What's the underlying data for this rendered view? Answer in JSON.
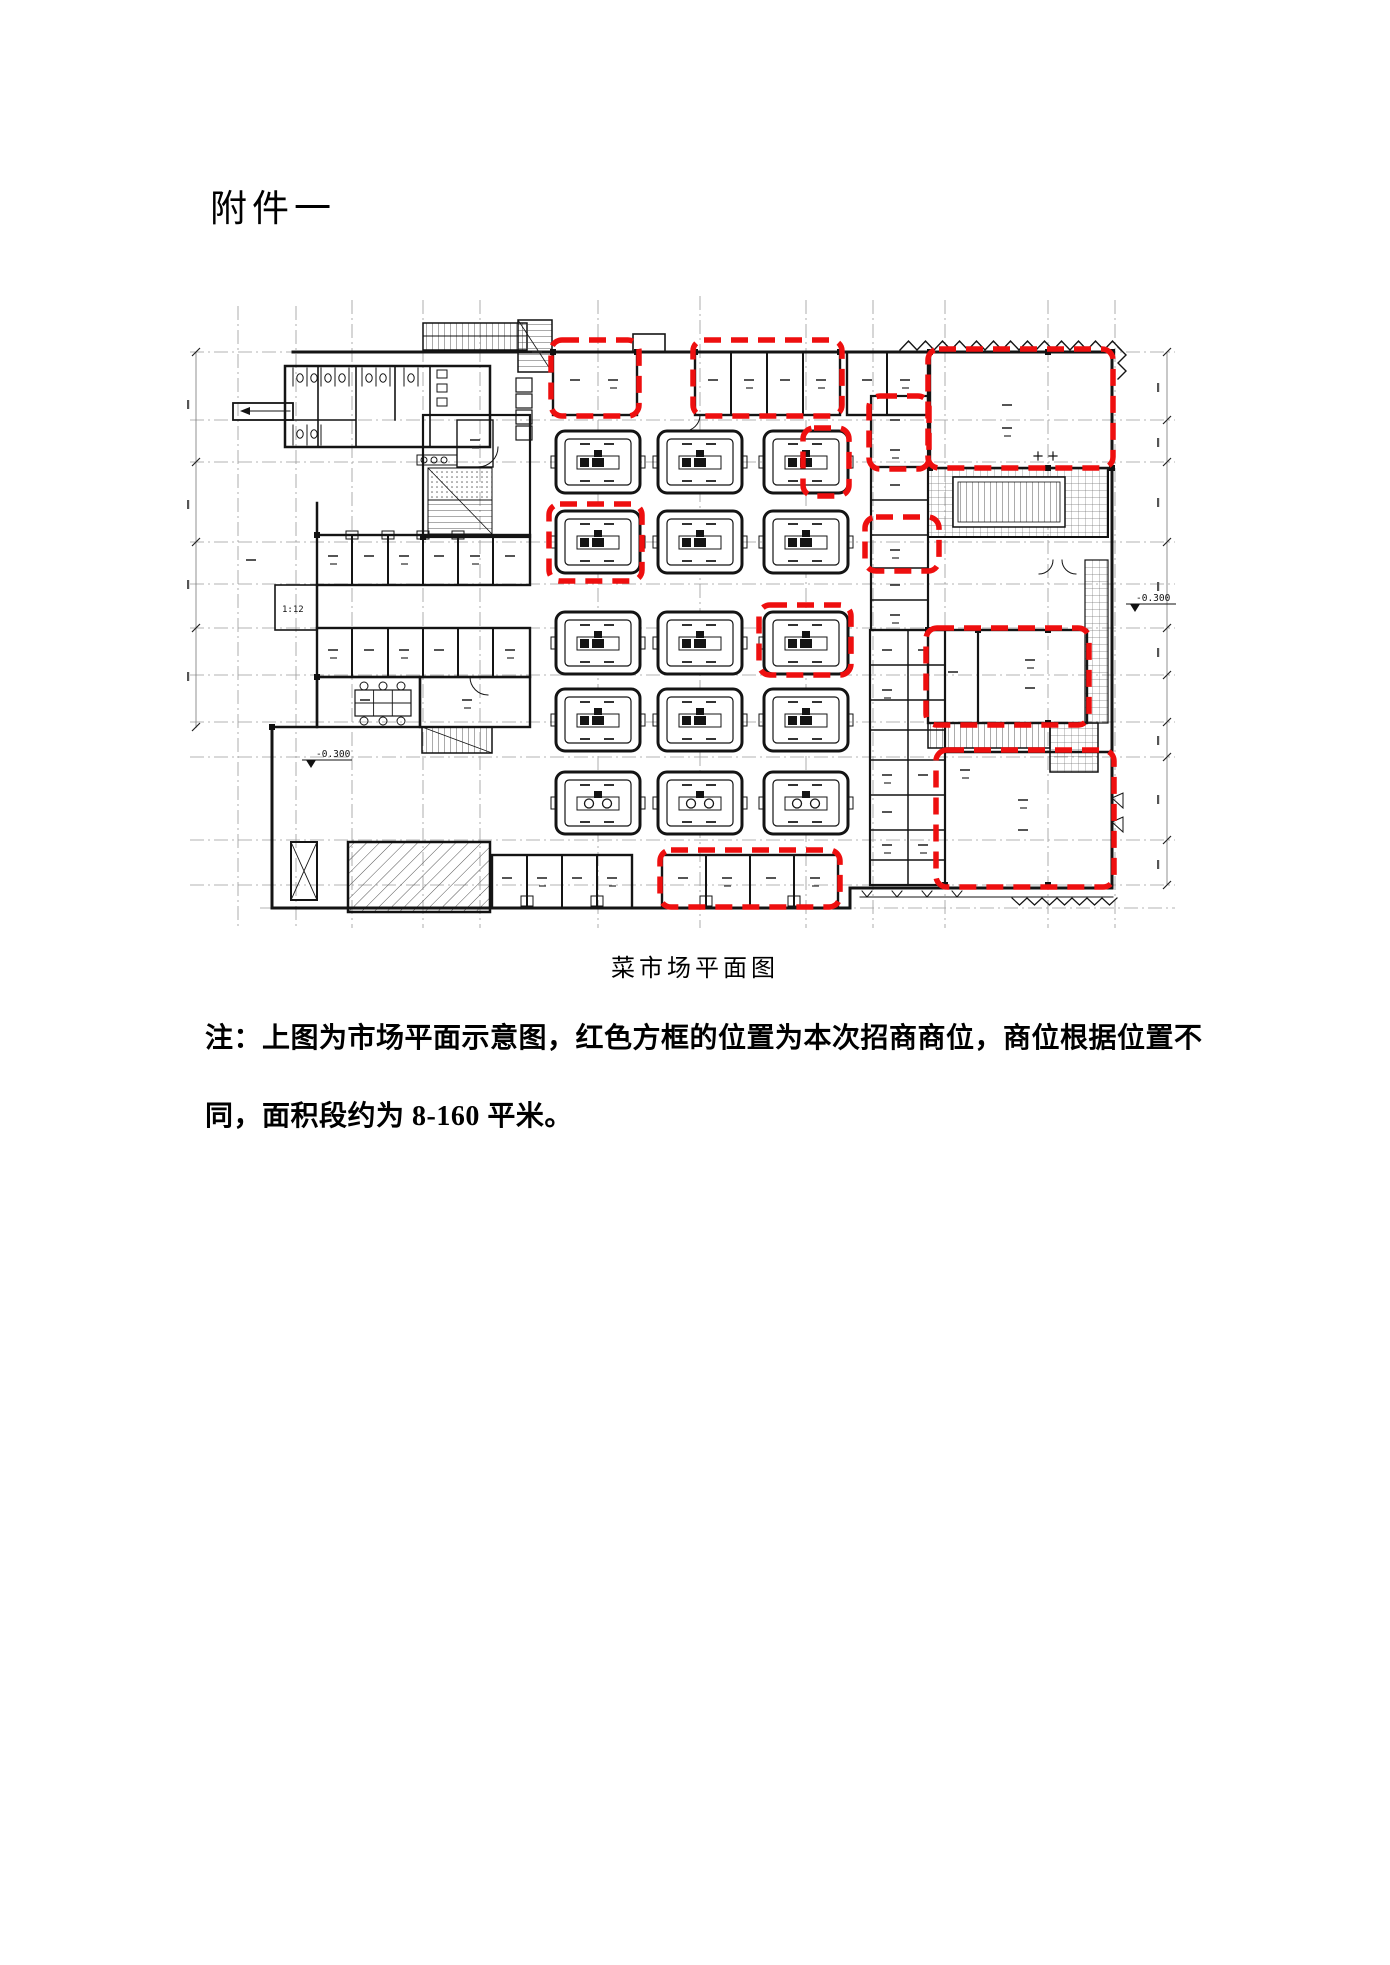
{
  "page": {
    "background": "#ffffff",
    "title": "附件一",
    "caption": "菜市场平面图",
    "note": {
      "line1": "注：上图为市场平面示意图，红色方框的位置为本次招商商位，商位根据位置不",
      "line2": "同，面积段约为 8-160 平米。"
    }
  },
  "floor_plan": {
    "type": "cad-floor-plan",
    "subject": "菜市场平面图（市场平面示意图）",
    "highlight_meaning": "红色方框为本次招商商位，面积段约 8-160 平米",
    "colors": {
      "walls": "#141414",
      "grid": "#9a9a9a",
      "highlight_red": "#ee0f0f",
      "hatch": "#666666"
    },
    "labels": {
      "ramp": "1:12",
      "elevation_left": "-0.300",
      "elevation_right": "-0.300"
    },
    "stall_islands": {
      "col_centers_x": [
        598,
        700,
        806
      ],
      "row_centers_y": [
        462,
        542,
        643,
        720,
        803
      ],
      "width": 84,
      "height": 62,
      "circle_row_index": 4
    },
    "red_boxes": [
      {
        "x": 551,
        "y": 340,
        "w": 88,
        "h": 76
      },
      {
        "x": 693,
        "y": 340,
        "w": 149,
        "h": 76
      },
      {
        "x": 928,
        "y": 349,
        "w": 185,
        "h": 119
      },
      {
        "x": 869,
        "y": 396,
        "w": 60,
        "h": 73
      },
      {
        "x": 803,
        "y": 428,
        "w": 46,
        "h": 68
      },
      {
        "x": 549,
        "y": 504,
        "w": 93,
        "h": 77
      },
      {
        "x": 865,
        "y": 517,
        "w": 74,
        "h": 54
      },
      {
        "x": 759,
        "y": 605,
        "w": 92,
        "h": 70
      },
      {
        "x": 926,
        "y": 628,
        "w": 163,
        "h": 97
      },
      {
        "x": 936,
        "y": 750,
        "w": 178,
        "h": 137
      },
      {
        "x": 660,
        "y": 850,
        "w": 180,
        "h": 57
      }
    ]
  }
}
